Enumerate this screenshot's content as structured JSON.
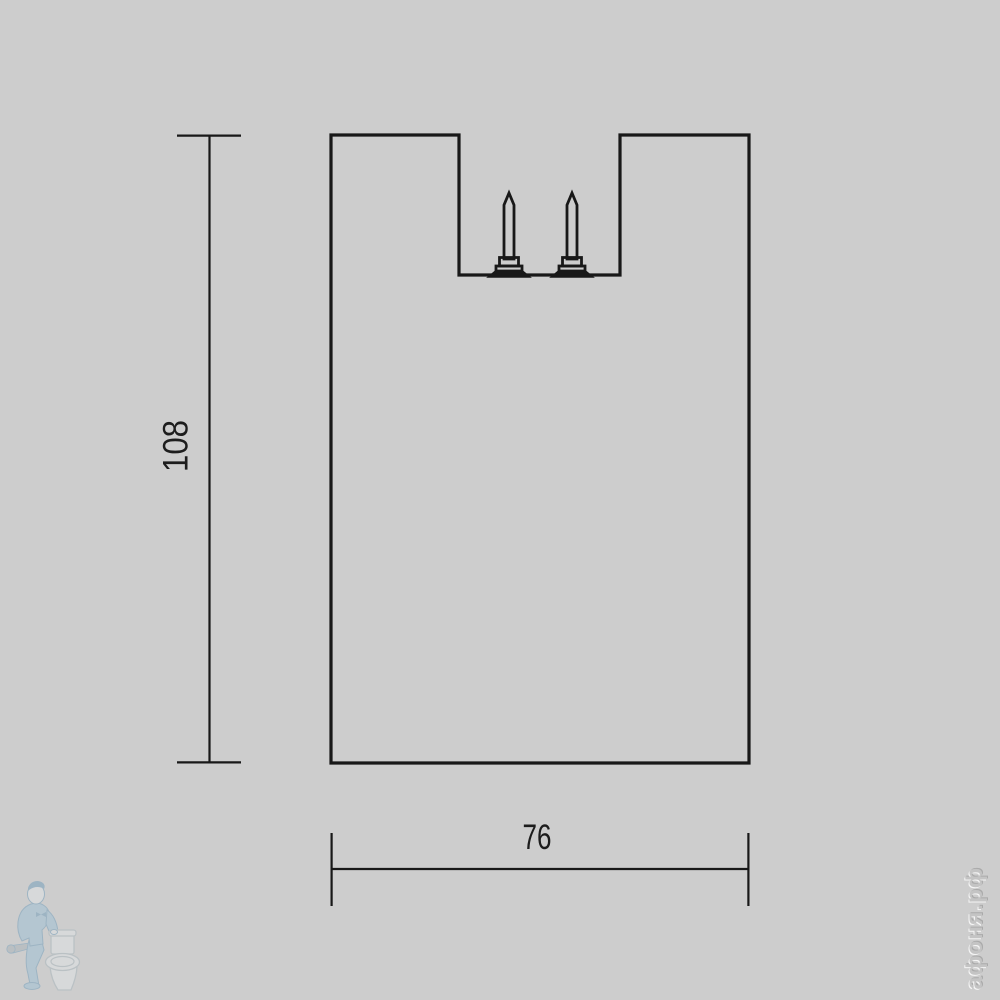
{
  "drawing": {
    "height_label": "108",
    "width_label": "76"
  },
  "watermark": {
    "brand": "афоня.рф",
    "logo_icon": "plumber-with-toilet-icon"
  },
  "colors": {
    "background": "#cdcdcd",
    "line": "#181818",
    "dim_text": "#1d1d1d",
    "logo_blue": "#9dc1d6",
    "logo_blue_dark": "#6f9cba",
    "porcelain": "#e2e6e8",
    "porcelain_outline": "#a9b6bd",
    "metal_gray": "#a9b2b8",
    "brand_text": "#c4c4c4"
  }
}
